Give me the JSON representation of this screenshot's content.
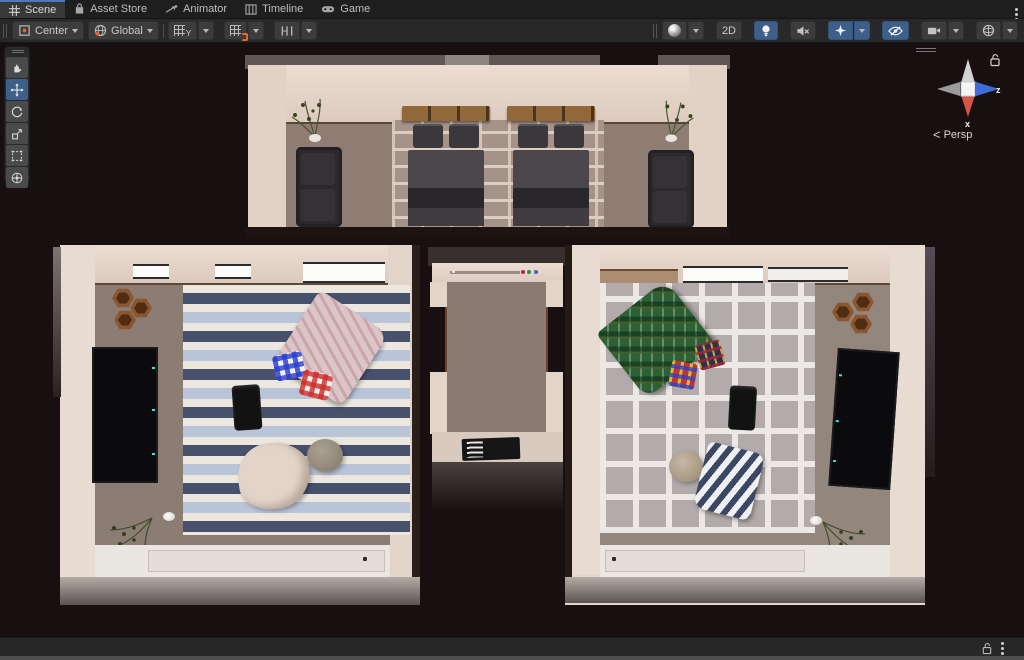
{
  "window": {
    "tabs": [
      {
        "label": "Scene",
        "active": true
      },
      {
        "label": "Asset Store",
        "active": false
      },
      {
        "label": "Animator",
        "active": false
      },
      {
        "label": "Timeline",
        "active": false
      },
      {
        "label": "Game",
        "active": false
      }
    ]
  },
  "toolbar": {
    "pivot_label": "Center",
    "orientation_label": "Global",
    "grid_axis_label": "Y",
    "mode_2d_label": "2D"
  },
  "tools": {
    "active": "move-tool",
    "items": [
      "view-hand-tool",
      "move-tool",
      "rotate-tool",
      "scale-tool",
      "rect-tool",
      "transform-tool"
    ]
  },
  "gizmo": {
    "axis_x_label": "x",
    "axis_z_label": "z",
    "projection_label": "Persp",
    "chevron": "<"
  },
  "colors": {
    "active_tool_blue": "#3e5f8a",
    "tab_accent_blue": "#4a7ab8",
    "axis_x_red": "#d65348",
    "axis_z_blue": "#3f6cd6",
    "snap_accent_orange": "#e8642d",
    "viewport_background": "#181010"
  },
  "scene": {
    "view": "top-down perspective of a three-room apartment interior",
    "rooms": [
      {
        "name": "bedroom-north",
        "items": [
          "double-bed",
          "double-bed",
          "sofa",
          "sofa",
          "potted-plant",
          "potted-plant",
          "brick-pattern-rug"
        ]
      },
      {
        "name": "living-room-west",
        "items": [
          "blue-striped-rug",
          "wall-tv",
          "hex-wall-shelf",
          "pink-blanket",
          "blue-gingham-pillow",
          "red-gingham-pillow",
          "black-bag",
          "beige-blanket",
          "gray-pouf",
          "potted-plant",
          "ceiling-light-panels",
          "window-ledge"
        ]
      },
      {
        "name": "hallway-center",
        "items": [
          "black-doormat",
          "shelf-trinkets"
        ]
      },
      {
        "name": "living-room-east",
        "items": [
          "gray-grid-rug",
          "wall-tv",
          "hex-wall-shelf",
          "green-tartan-blanket",
          "multicolor-plaid-cube",
          "dark-plaid-cube",
          "black-bag",
          "navy-striped-towel",
          "beige-pouf",
          "potted-plant",
          "ceiling-light-panels",
          "window-ledge"
        ]
      }
    ]
  },
  "statusbar": {
    "icons": [
      "unlock-icon",
      "kebab-menu-icon"
    ]
  }
}
